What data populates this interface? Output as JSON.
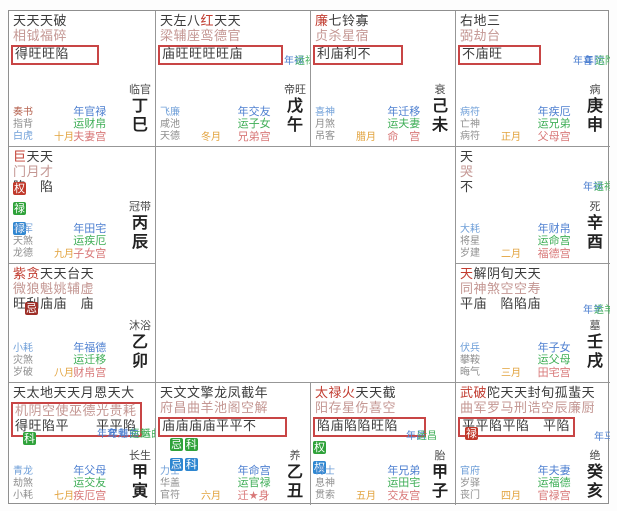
{
  "colors": {
    "highlight_box_red": "#c84545",
    "badge_red": "#c0392b",
    "badge_green": "#2fa23a",
    "badge_blue": "#2e86d0",
    "badge_darkred": "#9e2f28",
    "year_label_blue": "#4d7fd0",
    "decade_label_green": "#3fae57",
    "natal_palace_pink": "#d87878",
    "month_orange": "#e2a23c",
    "major_star_red": "#c13c30"
  },
  "cells": [
    {
      "id": "ding-si",
      "stars_top": "天天天破",
      "stars_bottom": "相钺福碎",
      "red_indices": [],
      "brightness": "得旺旺陷",
      "boxed": true,
      "box_includes_line2": false,
      "badges": [],
      "markers": [],
      "gods": [
        "奏书",
        "指背",
        "白虎"
      ],
      "gods_colors": [
        "red",
        "gray",
        "blue"
      ],
      "month": "十月",
      "palaces": [
        "年官禄",
        "运财帛",
        "夫妻宫"
      ],
      "stage": "临官",
      "branch": "丁巳"
    },
    {
      "id": "wu-wu",
      "stars_top": "天左八红天天",
      "stars_bottom": "梁辅座鸾德官",
      "red_indices": [
        3
      ],
      "brightness": "庙旺旺旺旺庙",
      "boxed": true,
      "box_includes_line2": false,
      "badges": [],
      "markers": [
        {
          "t": "年禄",
          "c": "blue"
        },
        {
          "t": "运禄",
          "c": "green"
        }
      ],
      "gods": [
        "飞廉",
        "咸池",
        "天德"
      ],
      "gods_colors": [
        "blue",
        "gray",
        "gray"
      ],
      "month": "冬月",
      "palaces": [
        "年交友",
        "运子女",
        "兄弟宫"
      ],
      "stage": "帝旺",
      "branch": "戊午"
    },
    {
      "id": "ji-wei",
      "stars_top": "廉七铃寡",
      "stars_bottom": "贞杀星宿",
      "red_indices": [
        0
      ],
      "brightness": "利庙利不",
      "boxed": true,
      "box_includes_line2": false,
      "badges": [],
      "markers": [],
      "gods": [
        "喜神",
        "月煞",
        "吊客"
      ],
      "gods_colors": [
        "blue",
        "gray",
        "gray"
      ],
      "month": "腊月",
      "palaces": [
        "年迁移",
        "运夫妻",
        "命　宫"
      ],
      "stage": "衰",
      "branch": "己未"
    },
    {
      "id": "geng-shen",
      "stars_top": "右地三",
      "stars_bottom": "弼劫台",
      "red_indices": [],
      "brightness": "不庙旺",
      "boxed": true,
      "box_includes_line2": false,
      "badges": [],
      "markers": [
        {
          "t": "年喜",
          "c": "blue"
        },
        {
          "t": "年陀",
          "c": "blue"
        },
        {
          "t": "运陀",
          "c": "green"
        }
      ],
      "gods": [
        "病符",
        "亡神",
        "病符"
      ],
      "gods_colors": [
        "blue",
        "gray",
        "gray"
      ],
      "month": "正月",
      "palaces": [
        "年疾厄",
        "运兄弟",
        "父母宫"
      ],
      "stage": "病",
      "branch": "庚申"
    },
    {
      "id": "bing-chen",
      "stars_top": "巨天天",
      "stars_bottom": "门月才",
      "red_indices": [
        0
      ],
      "brightness": "陷　陷",
      "boxed": false,
      "box_includes_line2": false,
      "badges": [
        [
          {
            "t": "权",
            "bg": "red"
          }
        ],
        [
          {
            "t": "禄",
            "bg": "green"
          }
        ],
        [
          {
            "t": "禄",
            "bg": "blue"
          }
        ]
      ],
      "markers": [],
      "gods": [
        "将军",
        "天煞",
        "龙德"
      ],
      "gods_colors": [
        "blue",
        "gray",
        "gray"
      ],
      "month": "九月",
      "palaces": [
        "年田宅",
        "运疾厄",
        "子女宫"
      ],
      "stage": "冠带",
      "branch": "丙辰"
    },
    {
      "id": "xin-you",
      "stars_top": "天",
      "stars_bottom": "哭",
      "red_indices": [],
      "brightness": "不",
      "boxed": false,
      "box_includes_line2": false,
      "badges": [],
      "markers": [
        {
          "t": "年禄",
          "c": "blue"
        },
        {
          "t": "运禄",
          "c": "green"
        }
      ],
      "gods": [
        "大耗",
        "将星",
        "岁建"
      ],
      "gods_colors": [
        "blue",
        "gray",
        "gray"
      ],
      "month": "二月",
      "palaces": [
        "年财帛",
        "运命宫",
        "福德宫"
      ],
      "stage": "死",
      "branch": "辛酉"
    },
    {
      "id": "yi-mao",
      "stars_top": "紫贪天天台天",
      "stars_bottom": "微狼魁姚辅虚",
      "red_indices": [
        0,
        1
      ],
      "brightness": "旺利庙庙　庙",
      "boxed": false,
      "box_includes_line2": false,
      "badges": [
        [
          {
            "t": "忌",
            "bg": "darkred"
          }
        ]
      ],
      "markers": [],
      "gods": [
        "小耗",
        "灾煞",
        "岁破"
      ],
      "gods_colors": [
        "blue",
        "gray",
        "gray"
      ],
      "month": "八月",
      "palaces": [
        "年福德",
        "运迁移",
        "财帛宫"
      ],
      "stage": "沐浴",
      "branch": "乙卯"
    },
    {
      "id": "ren-xu",
      "stars_top": "天解阴旬天天",
      "stars_bottom": "同神煞空空寿",
      "red_indices": [
        0
      ],
      "brightness": "平庙　陷陷庙",
      "boxed": false,
      "box_includes_line2": false,
      "badges": [],
      "markers": [
        {
          "t": "年羊",
          "c": "blue"
        },
        {
          "t": "运羊",
          "c": "green"
        }
      ],
      "gods": [
        "伏兵",
        "攀鞍",
        "晦气"
      ],
      "gods_colors": [
        "blue",
        "gray",
        "gray"
      ],
      "month": "三月",
      "palaces": [
        "年子女",
        "运父母",
        "田宅宫"
      ],
      "stage": "墓",
      "branch": "壬戌"
    },
    {
      "id": "jia-yin",
      "stars_top": "天太地天天月恩天大",
      "stars_bottom": "机阴空使巫德光贵耗",
      "red_indices": [],
      "brightness": "得旺陷平　　平平陷",
      "boxed": true,
      "box_includes_line2": true,
      "badges": [
        [
          {
            "t": "科",
            "bg": "green"
          }
        ]
      ],
      "markers": [
        {
          "t": "年鸾",
          "c": "blue"
        },
        {
          "t": "年魁",
          "c": "blue"
        },
        {
          "t": "年曲",
          "c": "blue"
        },
        {
          "t": "运魁",
          "c": "green"
        },
        {
          "t": "运曲",
          "c": "green"
        }
      ],
      "gods": [
        "青龙",
        "劫煞",
        "小耗"
      ],
      "gods_colors": [
        "blue",
        "gray",
        "gray"
      ],
      "month": "七月",
      "palaces": [
        "年父母",
        "运交友",
        "疾厄宫"
      ],
      "stage": "长生",
      "branch": "甲寅"
    },
    {
      "id": "yi-chou",
      "stars_top": "天文文擎龙凤截年",
      "stars_bottom": "府昌曲羊池阁空解",
      "red_indices": [],
      "brightness": "庙庙庙庙平平不",
      "boxed": true,
      "box_includes_line2": false,
      "badges": [
        [
          {
            "t": "忌",
            "bg": "green"
          },
          {
            "t": "科",
            "bg": "green"
          }
        ],
        [
          {
            "t": "忌",
            "bg": "blue"
          },
          {
            "t": "科",
            "bg": "blue"
          }
        ]
      ],
      "markers": [],
      "gods": [
        "力士",
        "华盖",
        "官符"
      ],
      "gods_colors": [
        "blue",
        "gray",
        "gray"
      ],
      "month": "六月",
      "palaces": [
        "年命宫",
        "运官禄",
        "迁★身"
      ],
      "stage": "养",
      "branch": "乙丑"
    },
    {
      "id": "jia-zi",
      "stars_top": "太禄火天天截",
      "stars_bottom": "阳存星伤喜空",
      "red_indices": [
        0,
        1,
        2
      ],
      "brightness": "陷庙陷陷旺陷",
      "boxed": true,
      "box_includes_line2": false,
      "badges": [
        [
          {
            "t": "权",
            "bg": "green"
          }
        ],
        [
          {
            "t": "权",
            "bg": "blue"
          }
        ]
      ],
      "markers": [
        {
          "t": "年昌",
          "c": "blue"
        },
        {
          "t": "运昌",
          "c": "green"
        }
      ],
      "gods": [
        "博士",
        "息神",
        "贯索"
      ],
      "gods_colors": [
        "blue",
        "gray",
        "gray"
      ],
      "month": "五月",
      "palaces": [
        "年兄弟",
        "运田宅",
        "交友宫"
      ],
      "stage": "胎",
      "branch": "甲子"
    },
    {
      "id": "gui-hai",
      "stars_top": "武破陀天天封旬孤蜚天",
      "stars_bottom": "曲军罗马刑诰空辰廉厨",
      "red_indices": [
        0,
        1
      ],
      "brightness": "平平陷平陷　平陷",
      "boxed": true,
      "box_includes_line2": false,
      "badges": [
        [
          {
            "t": "禄",
            "bg": "red"
          }
        ]
      ],
      "markers": [
        {
          "t": "年马",
          "c": "blue"
        }
      ],
      "gods": [
        "官府",
        "岁驿",
        "丧门"
      ],
      "gods_colors": [
        "blue",
        "gray",
        "gray"
      ],
      "month": "四月",
      "palaces": [
        "年夫妻",
        "运福德",
        "官禄宫"
      ],
      "stage": "绝",
      "branch": "癸亥"
    }
  ]
}
